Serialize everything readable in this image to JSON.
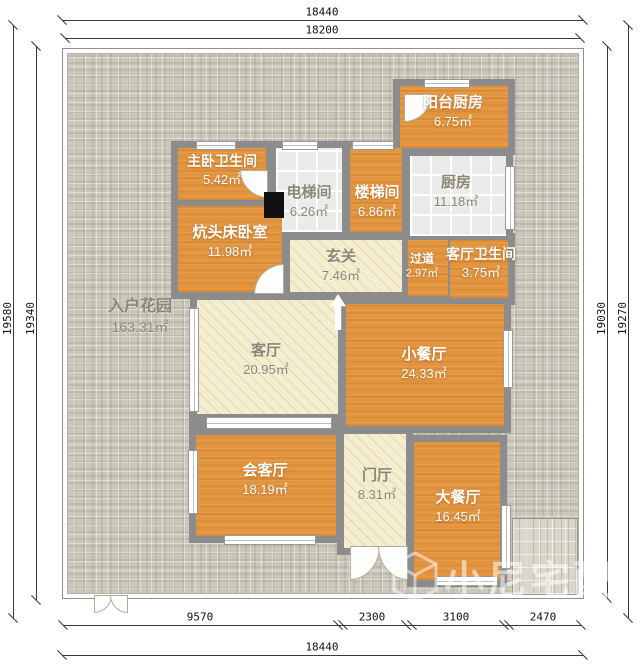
{
  "watermark": {
    "text": "小尼宅配"
  },
  "dimensions": {
    "top_outer": "18440",
    "top_inner": "18200",
    "bottom_segments": [
      "9570",
      "2300",
      "3100",
      "2470"
    ],
    "bottom_total": "18440",
    "left_outer": "19580",
    "left_inner": "19340",
    "right_inner": "19030",
    "right_outer": "19270"
  },
  "garden": {
    "name": "入户花园",
    "area": "163.31㎡"
  },
  "rooms": [
    {
      "name": "阳台厨房",
      "area": "6.75㎡"
    },
    {
      "name": "厨房",
      "area": "11.18㎡"
    },
    {
      "name": "主卧卫生间",
      "area": "5.42㎡"
    },
    {
      "name": "电梯间",
      "area": "6.26㎡"
    },
    {
      "name": "楼梯间",
      "area": "6.86㎡"
    },
    {
      "name": "炕头床卧室",
      "area": "11.98㎡"
    },
    {
      "name": "玄关",
      "area": "7.46㎡"
    },
    {
      "name": "过道",
      "area": "2.97㎡"
    },
    {
      "name": "客厅卫生间",
      "area": "3.75㎡"
    },
    {
      "name": "客厅",
      "area": "20.95㎡"
    },
    {
      "name": "小餐厅",
      "area": "24.33㎡"
    },
    {
      "name": "会客厅",
      "area": "18.19㎡"
    },
    {
      "name": "门厅",
      "area": "8.31㎡"
    },
    {
      "name": "大餐厅",
      "area": "16.45㎡"
    }
  ],
  "colors": {
    "room_orange": "#e3943f",
    "room_cream": "#f4edd0",
    "room_tile": "#ebebe9",
    "wall_gray": "#8c8c8c",
    "garden": "#cbc7ba"
  }
}
